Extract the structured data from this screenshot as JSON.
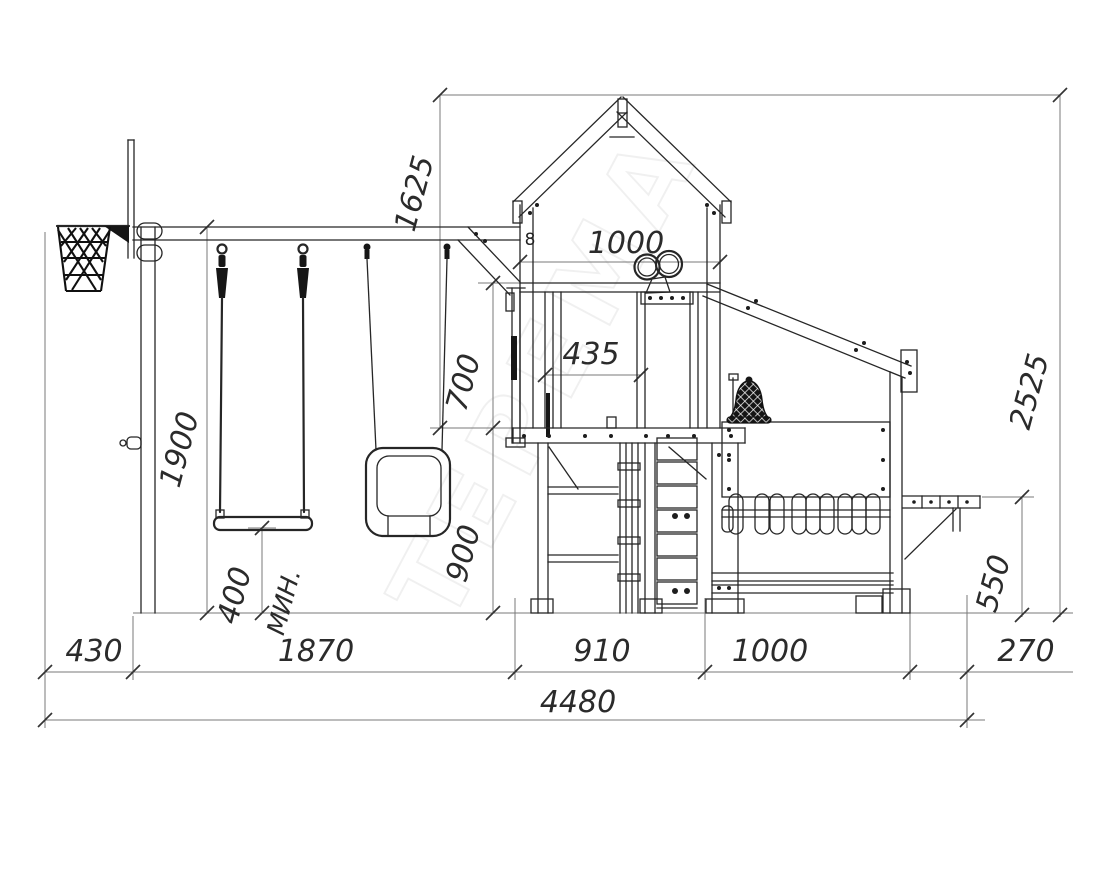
{
  "drawing": {
    "watermark": "ТЕРЕМА",
    "detail_label": "8",
    "dims": {
      "seg_430": "430",
      "seg_1870": "1870",
      "seg_910": "910",
      "seg_1000": "1000",
      "seg_270": "270",
      "total_width": "4480",
      "house_width": "1000",
      "window_width": "435",
      "roof_to_platform": "1625",
      "beam_height": "1900",
      "sill_to_platform": "700",
      "platform_height": "900",
      "seat_clearance": "400",
      "seat_clearance_note": "МИН.",
      "bench_height": "550",
      "total_height": "2525"
    }
  }
}
